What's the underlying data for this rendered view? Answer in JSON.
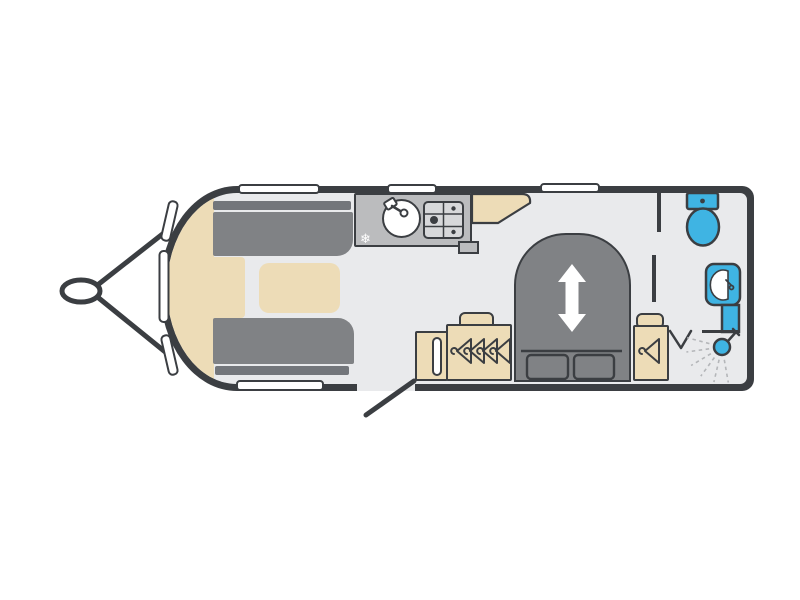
{
  "diagram": {
    "type": "caravan-floorplan",
    "view": "top-down",
    "orientation": "tow-hitch-left"
  },
  "colors": {
    "wall": "#3b3e42",
    "floor": "#e9eaec",
    "upholstery": "#808285",
    "upholstery-dark": "#73767b",
    "wood": "#eddcb7",
    "worktop": "#bbbcbe",
    "hob": "#d7d8da",
    "fixture-blue": "#3fb4e3",
    "window": "#ffffff",
    "spray": "#b4b6b9"
  },
  "icons": {
    "snowflake_glyph": "❄",
    "names": [
      "snowflake-icon",
      "tap-icon",
      "coat-hanger-icon",
      "bed-extend-arrow-icon",
      "shower-head-icon",
      "toilet-icon",
      "basin-icon"
    ]
  },
  "zones": {
    "front_lounge": {
      "items": [
        "parallel-sofa-top",
        "parallel-sofa-bottom",
        "front-chest",
        "occasional-table"
      ]
    },
    "kitchen": {
      "items": [
        "worktop",
        "round-sink-with-tap",
        "three-burner-hob",
        "freezer-snowflake",
        "overhead-locker"
      ]
    },
    "bedroom": {
      "items": [
        "island-bed-extending",
        "pillows-x2",
        "wardrobe-four-hangers",
        "wardrobe-single-hanger",
        "slatted-unit-by-door"
      ]
    },
    "washroom": {
      "items": [
        "toilet-with-cistern",
        "washbasin-with-tap",
        "vanity-shelf",
        "shower-head-with-spray",
        "bifold-door-v-mark"
      ]
    }
  },
  "openings": {
    "windows_top": 3,
    "windows_bottom": 1,
    "windows_front_curve": 3,
    "entrance_door": {
      "position": "bottom-centre",
      "state": "open-diagonal"
    }
  },
  "exterior": {
    "tow_hitch": "a-frame-with-coupling-left"
  },
  "counts": {
    "coat_hangers_left_wardrobe": 4,
    "coat_hangers_right_wardrobe": 1,
    "pillows": 2,
    "hob_burners": 3
  }
}
